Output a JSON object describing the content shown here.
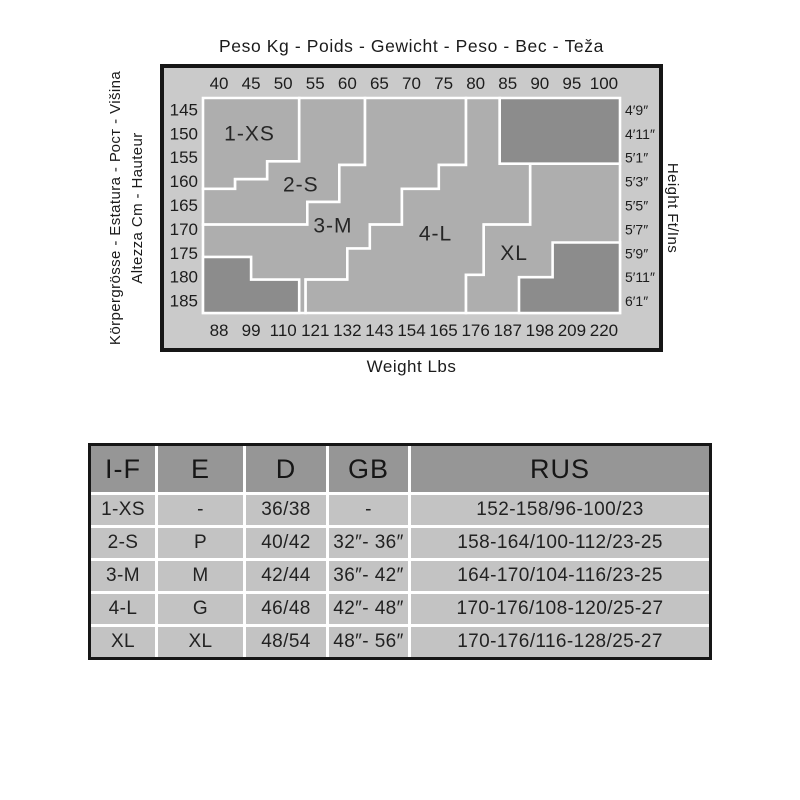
{
  "chart_data": {
    "type": "heatmap",
    "title": "Peso Kg - Poids - Gewicht - Peso - Вес - Teža",
    "xlabel_bottom": "Weight Lbs",
    "ylabel_left_outer": "Körpergrösse - Estatura - Рост - Višina",
    "ylabel_left_inner": "Altezza Cm - Hauteur",
    "ylabel_right": "Height Ft/Ins",
    "x_ticks_kg": [
      "40",
      "45",
      "50",
      "55",
      "60",
      "65",
      "70",
      "75",
      "80",
      "85",
      "90",
      "95",
      "100"
    ],
    "x_ticks_lbs": [
      "88",
      "99",
      "110",
      "121",
      "132",
      "143",
      "154",
      "165",
      "176",
      "187",
      "198",
      "209",
      "220"
    ],
    "y_ticks_cm": [
      "145",
      "150",
      "155",
      "160",
      "165",
      "170",
      "175",
      "180",
      "185"
    ],
    "y_ticks_ftin": [
      "4′9″",
      "4′11″",
      "5′1″",
      "5′3″",
      "5′5″",
      "5′7″",
      "5′9″",
      "5′11″",
      "6′1″"
    ],
    "grid": {
      "cols": 13,
      "rows": 9
    },
    "zones": [
      {
        "id": "xs",
        "label": "1-XS",
        "label_pos": [
          1.45,
          1.5
        ],
        "polygon": [
          [
            0,
            0
          ],
          [
            3,
            0
          ],
          [
            3,
            2.65
          ],
          [
            2,
            2.65
          ],
          [
            2,
            3.4
          ],
          [
            1,
            3.4
          ],
          [
            1,
            3.8
          ],
          [
            0,
            3.8
          ]
        ]
      },
      {
        "id": "s",
        "label": "2-S",
        "label_pos": [
          3.05,
          3.65
        ],
        "polygon": [
          [
            3,
            0
          ],
          [
            5.05,
            0
          ],
          [
            5.05,
            2.8
          ],
          [
            4.25,
            2.8
          ],
          [
            4.25,
            4.35
          ],
          [
            3.25,
            4.35
          ],
          [
            3.25,
            5.3
          ],
          [
            0,
            5.3
          ],
          [
            0,
            3.8
          ],
          [
            1,
            3.8
          ],
          [
            1,
            3.4
          ],
          [
            2,
            3.4
          ],
          [
            2,
            2.65
          ],
          [
            3,
            2.65
          ]
        ]
      },
      {
        "id": "m",
        "label": "3-M",
        "label_pos": [
          4.05,
          5.35
        ],
        "polygon": [
          [
            5.05,
            0
          ],
          [
            8.2,
            0
          ],
          [
            8.2,
            2.8
          ],
          [
            7.35,
            2.8
          ],
          [
            7.35,
            3.8
          ],
          [
            6.2,
            3.8
          ],
          [
            6.2,
            5.3
          ],
          [
            5.2,
            5.3
          ],
          [
            5.2,
            6.3
          ],
          [
            4.5,
            6.3
          ],
          [
            4.5,
            7.6
          ],
          [
            3.2,
            7.6
          ],
          [
            3.2,
            9
          ],
          [
            0,
            9
          ],
          [
            0,
            5.3
          ],
          [
            3.25,
            5.3
          ],
          [
            3.25,
            4.35
          ],
          [
            4.25,
            4.35
          ],
          [
            4.25,
            2.8
          ],
          [
            5.05,
            2.8
          ]
        ]
      },
      {
        "id": "l",
        "label": "4-L",
        "label_pos": [
          7.25,
          5.7
        ],
        "polygon": [
          [
            8.2,
            0
          ],
          [
            9.25,
            0
          ],
          [
            9.25,
            2.75
          ],
          [
            10.2,
            2.75
          ],
          [
            10.2,
            5.3
          ],
          [
            8.75,
            5.3
          ],
          [
            8.75,
            7.4
          ],
          [
            8.2,
            7.4
          ],
          [
            8.2,
            9
          ],
          [
            3.2,
            9
          ],
          [
            3.2,
            7.6
          ],
          [
            4.5,
            7.6
          ],
          [
            4.5,
            6.3
          ],
          [
            5.2,
            6.3
          ],
          [
            5.2,
            5.3
          ],
          [
            6.2,
            5.3
          ],
          [
            6.2,
            3.8
          ],
          [
            7.35,
            3.8
          ],
          [
            7.35,
            2.8
          ],
          [
            8.2,
            2.8
          ]
        ]
      },
      {
        "id": "xl",
        "label": "XL",
        "label_pos": [
          9.7,
          6.5
        ],
        "polygon": [
          [
            10.2,
            2.75
          ],
          [
            13,
            2.75
          ],
          [
            13,
            9
          ],
          [
            8.2,
            9
          ],
          [
            8.2,
            7.4
          ],
          [
            8.75,
            7.4
          ],
          [
            8.75,
            5.3
          ],
          [
            10.2,
            5.3
          ]
        ]
      }
    ],
    "excluded_regions": [
      {
        "id": "top-right",
        "polygon": [
          [
            9.25,
            0
          ],
          [
            13,
            0
          ],
          [
            13,
            2.75
          ],
          [
            9.25,
            2.75
          ]
        ]
      },
      {
        "id": "bottom-left",
        "polygon": [
          [
            0,
            6.65
          ],
          [
            1.5,
            6.65
          ],
          [
            1.5,
            7.6
          ],
          [
            3,
            7.6
          ],
          [
            3,
            9
          ],
          [
            0,
            9
          ]
        ]
      },
      {
        "id": "bottom-right",
        "polygon": [
          [
            10.9,
            6.05
          ],
          [
            13,
            6.05
          ],
          [
            13,
            9
          ],
          [
            9.85,
            9
          ],
          [
            9.85,
            7.5
          ],
          [
            10.9,
            7.5
          ]
        ]
      }
    ],
    "colors": {
      "frame_bg": "#cacaca",
      "zone_fill": "#aeaeae",
      "excluded_fill": "#8c8c8c",
      "zone_line": "#ffffff",
      "frame_border": "#161616",
      "tick_text": "#1c1c1c",
      "zone_text": "#262626"
    }
  },
  "table": {
    "headers": [
      "I-F",
      "E",
      "D",
      "GB",
      "RUS"
    ],
    "rows": [
      [
        "1-XS",
        "-",
        "36/38",
        "-",
        "152-158/96-100/23"
      ],
      [
        "2-S",
        "P",
        "40/42",
        "32″- 36″",
        "158-164/100-112/23-25"
      ],
      [
        "3-M",
        "M",
        "42/44",
        "36″- 42″",
        "164-170/104-116/23-25"
      ],
      [
        "4-L",
        "G",
        "46/48",
        "42″- 48″",
        "170-176/108-120/25-27"
      ],
      [
        "XL",
        "XL",
        "48/54",
        "48″- 56″",
        "170-176/116-128/25-27"
      ]
    ]
  }
}
